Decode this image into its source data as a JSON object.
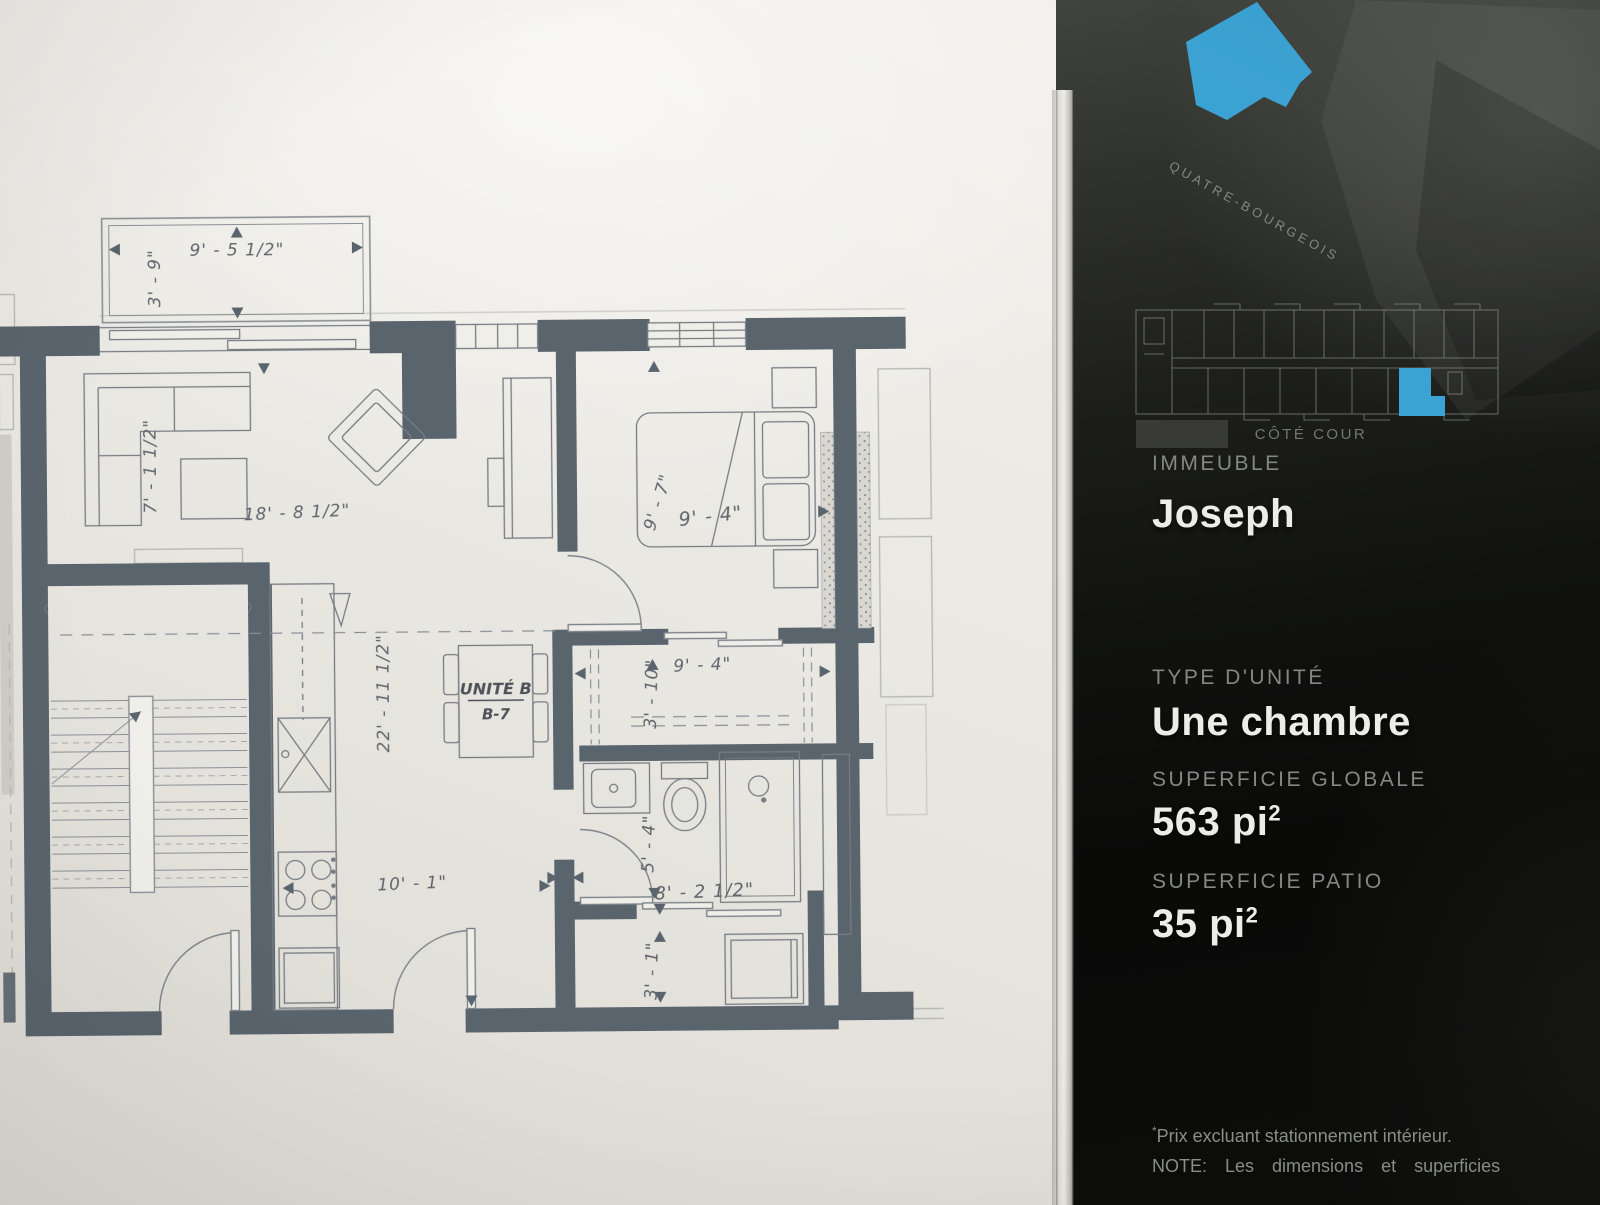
{
  "accent_color": "#3ba3d4",
  "plan": {
    "unit_label": "UNITÉ B",
    "unit_number": "B-7",
    "dims": {
      "balcony_w": "9' - 5 1/2\"",
      "balcony_d": "3' - 9\"",
      "living_side": "7' - 1 1/2\"",
      "living_w": "18' - 8 1/2\"",
      "living_l": "22' - 11 1/2\"",
      "bed_l": "9' - 7\"",
      "bed_w": "9' - 4\"",
      "closet_w": "9' - 4\"",
      "closet_d": "3' - 10\"",
      "bath_d": "5' - 4\"",
      "bath_w": "8' - 2 1/2\"",
      "kitchen_w": "10' - 1\"",
      "laundry_d": "3' - 1\""
    }
  },
  "panel": {
    "brand_name": "QUATRE-BOURGEOIS",
    "building_overview": {
      "caption": "CÔTÉ COUR"
    },
    "info": {
      "immeuble_label": "IMMEUBLE",
      "immeuble_value": "Joseph",
      "type_label": "TYPE D'UNITÉ",
      "type_value": "Une chambre",
      "area_label": "SUPERFICIE GLOBALE",
      "area_value": "563 pi",
      "area_exp": "2",
      "patio_label": "SUPERFICIE PATIO",
      "patio_value": "35 pi",
      "patio_exp": "2"
    },
    "footnotes": {
      "price_marker": "*",
      "price_text": "Prix excluant stationnement intérieur.",
      "note_text": "NOTE: Les dimensions et superficies"
    }
  }
}
